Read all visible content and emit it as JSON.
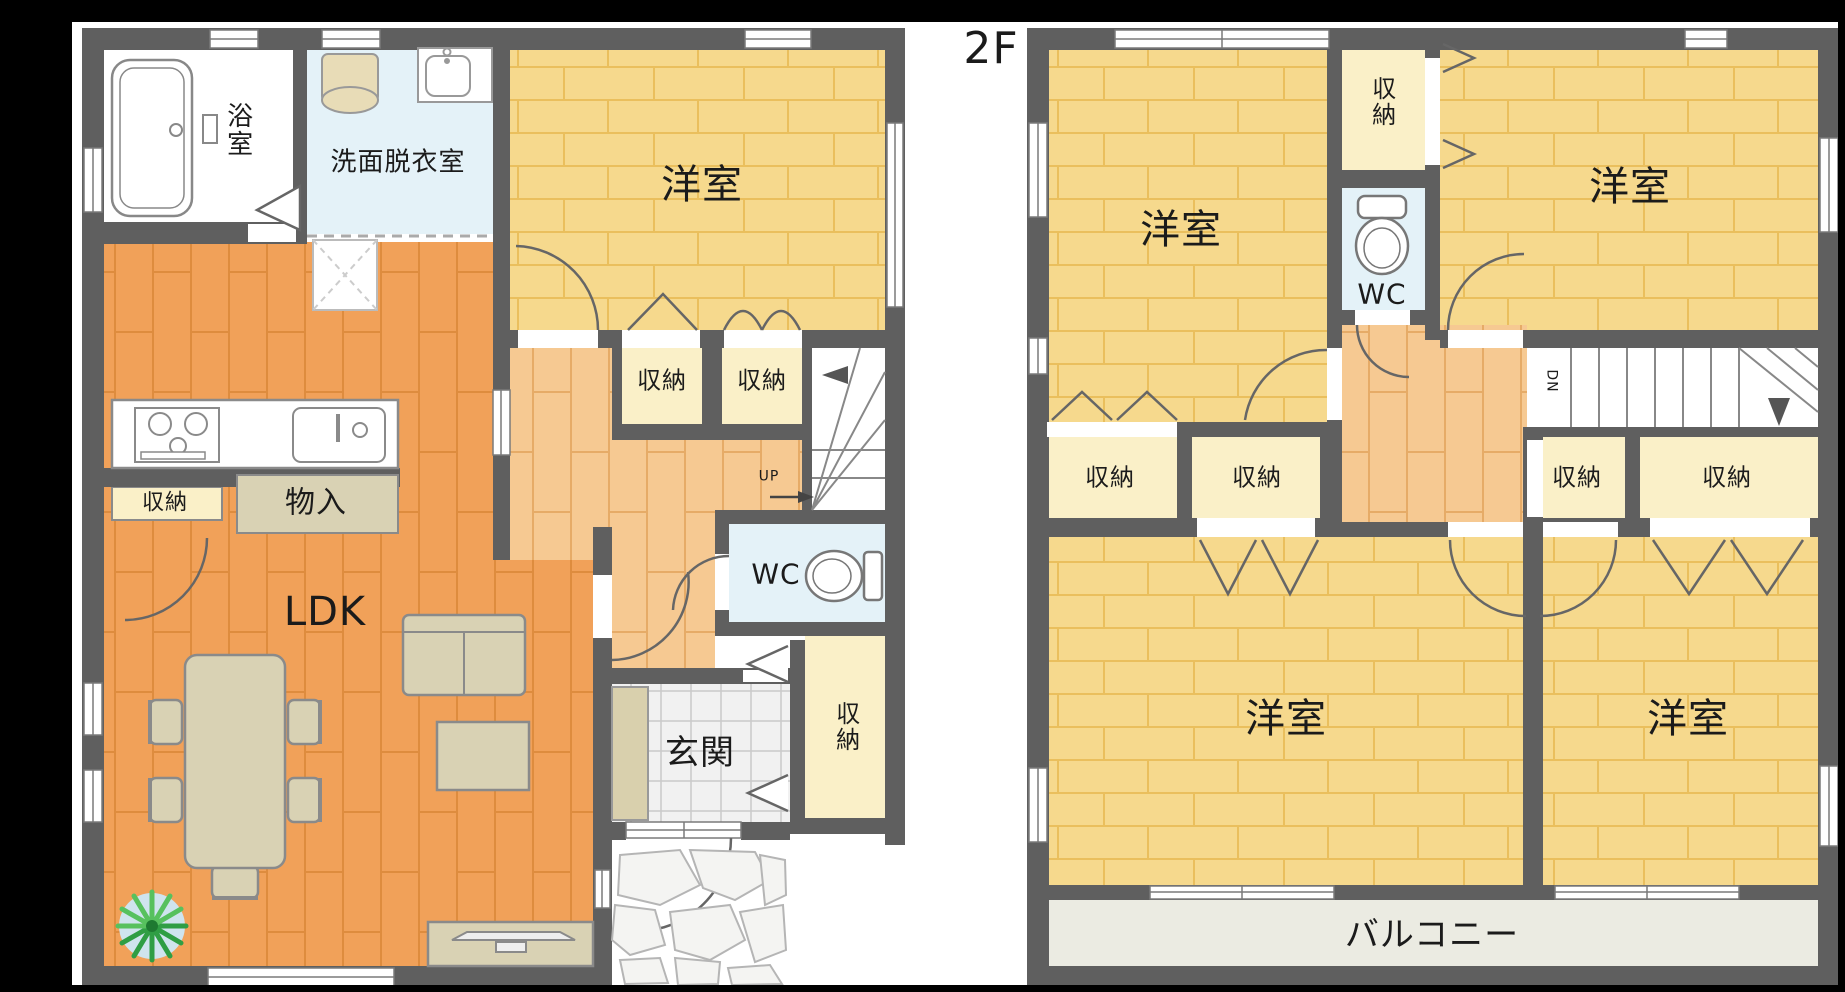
{
  "floor2_title": "2F",
  "floor1": {
    "bathroom": "浴室",
    "washroom": "洗面脱衣室",
    "western_room": "洋室",
    "storage_hall_a": "収納",
    "storage_hall_b": "収納",
    "kitchen_storage": "収納",
    "closet": "物入",
    "ldk": "LDK",
    "wc": "WC",
    "stairs_up": "UP",
    "entrance": "玄関",
    "entrance_storage": "収納"
  },
  "floor2": {
    "room_nw": "洋室",
    "room_ne": "洋室",
    "room_sw": "洋室",
    "room_se": "洋室",
    "storage_top": "収納",
    "wc": "WC",
    "stairs_down": "DN",
    "storage_1": "収納",
    "storage_2": "収納",
    "storage_3": "収納",
    "storage_4": "収納",
    "balcony": "バルコニー"
  },
  "colors": {
    "wall": "#5f5f5f",
    "room_yellow": "#f6d98d",
    "floor_orange": "#f1a159",
    "hall_orange": "#f6c992",
    "storage_cream": "#faf0c8",
    "water_blue": "#e4f2f8",
    "tile_gray": "#f1f1f1",
    "balcony_gray": "#ebebe2",
    "furniture_tan": "#d9d2b4",
    "plant_green": "#3fa84e"
  }
}
